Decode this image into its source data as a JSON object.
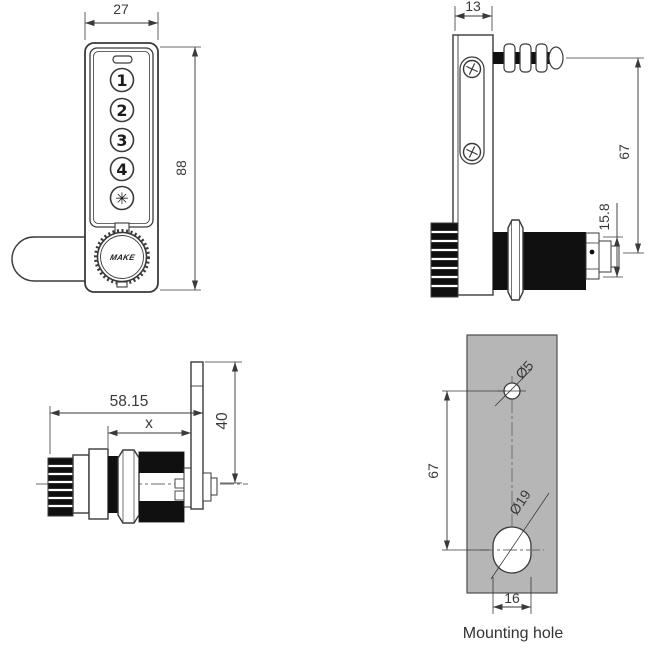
{
  "drawing": {
    "front_view": {
      "width_dim": "27",
      "height_dim": "88",
      "buttons": [
        "1",
        "2",
        "3",
        "4",
        "✳"
      ],
      "knob_logo": "MAKE"
    },
    "side_view": {
      "depth_dim": "13",
      "axis_spacing_dim": "67",
      "rear_height_dim": "15.8"
    },
    "barrel_view": {
      "total_length_dim": "58.15",
      "grip_range_dim": "x",
      "cam_length_dim": "40"
    },
    "mounting_view": {
      "hole_spacing_dim": "67",
      "small_hole_dim": "Ø5",
      "large_hole_dim": "Ø19",
      "hole_width_dim": "16",
      "caption": "Mounting hole"
    },
    "colors": {
      "line": "#3a3a3a",
      "panel_gray": "#b6b6b6",
      "fill_black": "#101010"
    }
  }
}
